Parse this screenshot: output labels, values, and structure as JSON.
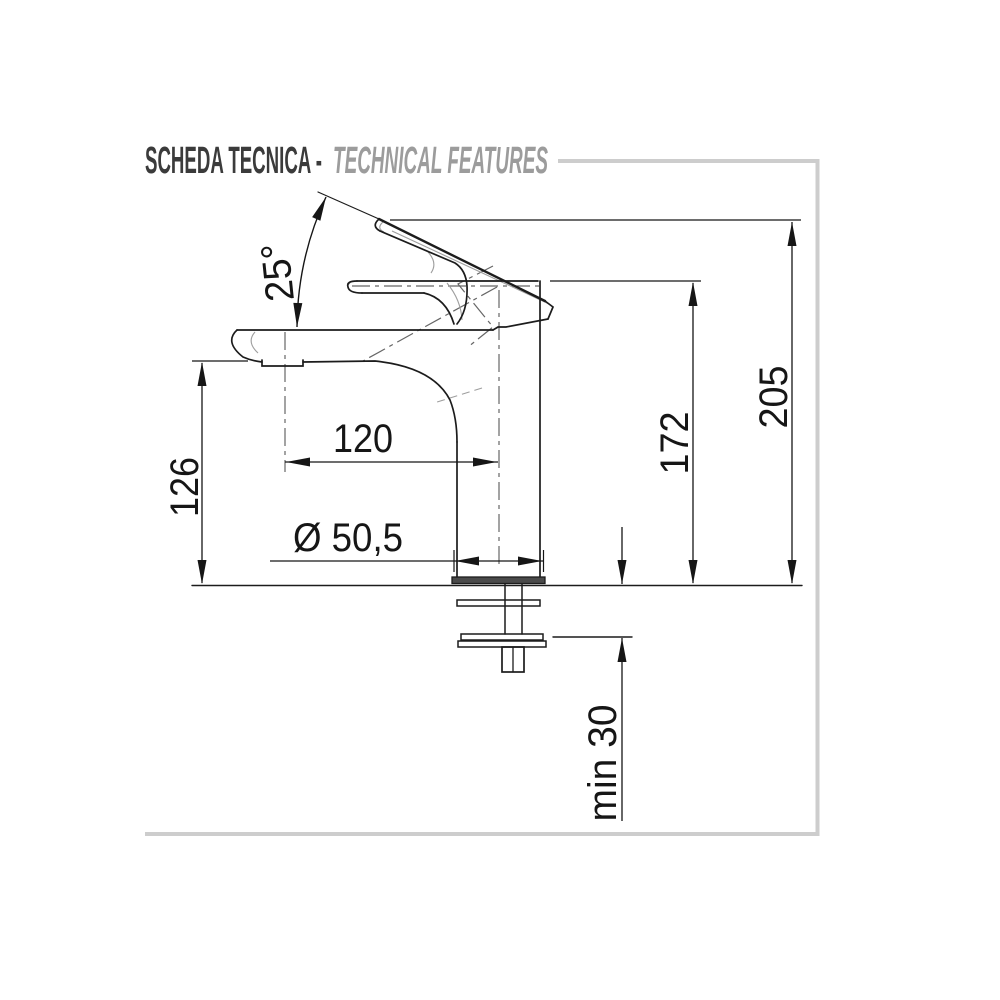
{
  "header": {
    "title_primary": "SCHEDA TECNICA -",
    "title_secondary": "TECHNICAL FEATURES"
  },
  "dimensions": {
    "handle_angle": "25°",
    "spout_reach": "120",
    "spout_outlet_height": "126",
    "base_diameter": "Ø 50,5",
    "handle_height": "172",
    "total_height": "205",
    "min_counter_thickness": "min 30"
  },
  "colors": {
    "outline": "#1c1c1c",
    "light_detail": "#9e9e9e",
    "construction": "#666666",
    "frame": "#cdcdcd",
    "title_primary": "#3b3b3b",
    "title_secondary": "#9c9c9c"
  }
}
